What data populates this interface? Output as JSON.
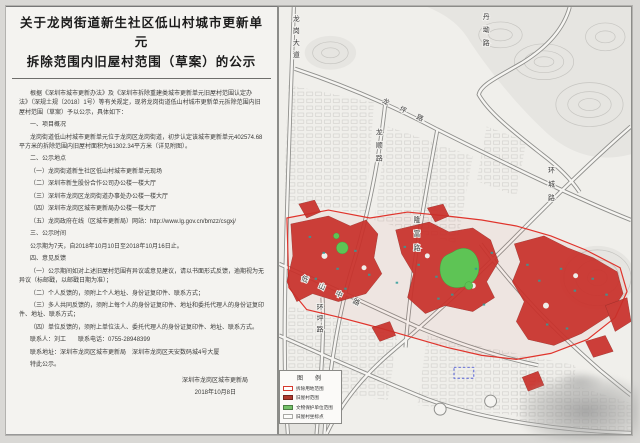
{
  "document": {
    "title_line1": "关于龙岗街道新生社区低山村城市更新单元",
    "title_line2": "拆除范围内旧屋村范围（草案）的公示",
    "paragraphs": [
      {
        "text": "根据《深圳市城市更新办法》及《深圳市拆除重建类城市更新单元旧屋村范围认定办法》（深规土规〔2018〕1号）等有关规定，现将龙岗街道低山村城市更新单元拆除范围内旧屋村范围（草案）予以公示，具体如下："
      },
      {
        "text": "一、项目概况"
      },
      {
        "text": "龙岗街道低山村城市更新单元位于龙岗区龙岗街道，初步认定该城市更新单元402574.68平方米的拆除范围内旧屋村面积为61302.34平方米（详见附图）。"
      },
      {
        "text": "二、公示地点"
      },
      {
        "text": "（一）龙岗街道新生社区低山村城市更新单元现场"
      },
      {
        "text": "（二）深圳市新生股份合作公司办公楼一楼大厅"
      },
      {
        "text": "（三）深圳市龙岗区龙岗街道办事处办公楼一楼大厅"
      },
      {
        "text": "（四）深圳市龙岗区城市更新局办公楼一楼大厅"
      },
      {
        "text": "（五）龙岗政府在线（区城市更新局）网站：http://www.lg.gov.cn/bmzz/csgxj/"
      },
      {
        "text": "三、公示时间"
      },
      {
        "text": "公示期为7天，自2018年10月10日至2018年10月16日止。"
      },
      {
        "text": "四、意见反馈"
      },
      {
        "text": "（一）公示期间如对上述旧屋村范围有异议或意见建议，请以书面形式反馈，逾期视为无异议（标邮戳，以邮戳日期为准）；"
      },
      {
        "text": "（二）个人反馈的，须附上个人地址、身份证复印件、联系方式；"
      },
      {
        "text": "（三）多人共同反馈的，须附上每个人的身份证复印件、地址和委托代理人的身份证复印件、地址、联系方式；"
      },
      {
        "text": "（四）单位反馈的，须附上单位法人、委托代理人的身份证复印件、地址、联系方式。"
      },
      {
        "text": "联系人：刘工　　联系电话：0755-28948399"
      },
      {
        "text": "联系地址：深圳市龙岗区城市更新局　深圳市龙岗区天安数码城4号大厦"
      },
      {
        "text": "特此公示。"
      }
    ],
    "signature_org": "深圳市龙岗区城市更新局",
    "signature_date": "2018年10月8日"
  },
  "map": {
    "road_labels": [
      {
        "text": "龙岗大道"
      },
      {
        "text": "丹坳路"
      },
      {
        "text": "龙坪路"
      },
      {
        "text": "龙顺路"
      },
      {
        "text": "环城路"
      },
      {
        "text": "隆富路"
      },
      {
        "text": "低山中路"
      },
      {
        "text": "环坪路"
      }
    ],
    "legend": {
      "title": "图　例",
      "items": [
        {
          "label": "拆除用地范围",
          "color": "#d63a2f"
        },
        {
          "label": "旧屋村范围",
          "color": "#b03a2e"
        },
        {
          "label": "文物保护单位范围",
          "color": "#74c168"
        },
        {
          "label": "旧屋村坐标点",
          "color": "#a9a9a5"
        }
      ]
    },
    "colors": {
      "old_village_fill": "#c9302a",
      "heritage_green": "#5ec455",
      "demolition_line": "#e0342c",
      "road_grey": "#8f8f8c"
    }
  }
}
